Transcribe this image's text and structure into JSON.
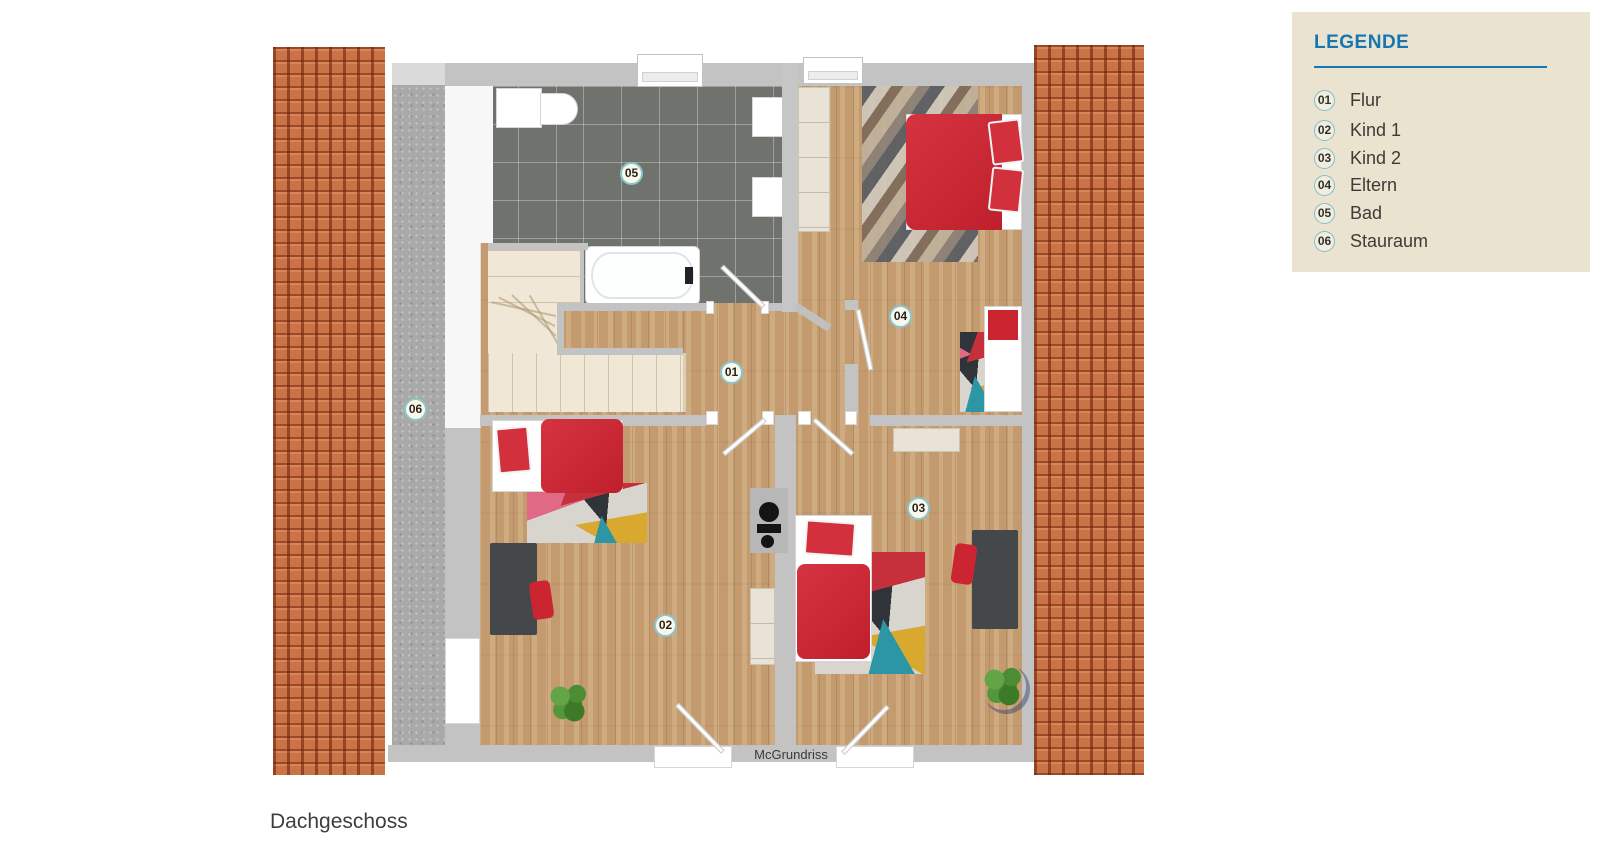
{
  "legend": {
    "title": "LEGENDE",
    "items": [
      {
        "num": "01",
        "label": "Flur"
      },
      {
        "num": "02",
        "label": "Kind 1"
      },
      {
        "num": "03",
        "label": "Kind 2"
      },
      {
        "num": "04",
        "label": "Eltern"
      },
      {
        "num": "05",
        "label": "Bad"
      },
      {
        "num": "06",
        "label": "Stauraum"
      }
    ]
  },
  "plan": {
    "markers": [
      "01",
      "02",
      "03",
      "04",
      "05",
      "06"
    ],
    "watermark": "McGrundriss"
  },
  "caption": "Dachgeschoss",
  "colors": {
    "accent_blue": "#1576b4",
    "legend_bg": "#eae3d0",
    "marker_border": "#8ac6cf",
    "roof_tile": "#c97347",
    "wall_gray": "#c3c3c3",
    "wood_floor": "#c39b6e",
    "bath_tile": "#6f726d",
    "furniture_red": "#cb2531",
    "stairs_cream": "#f0e7d6"
  }
}
